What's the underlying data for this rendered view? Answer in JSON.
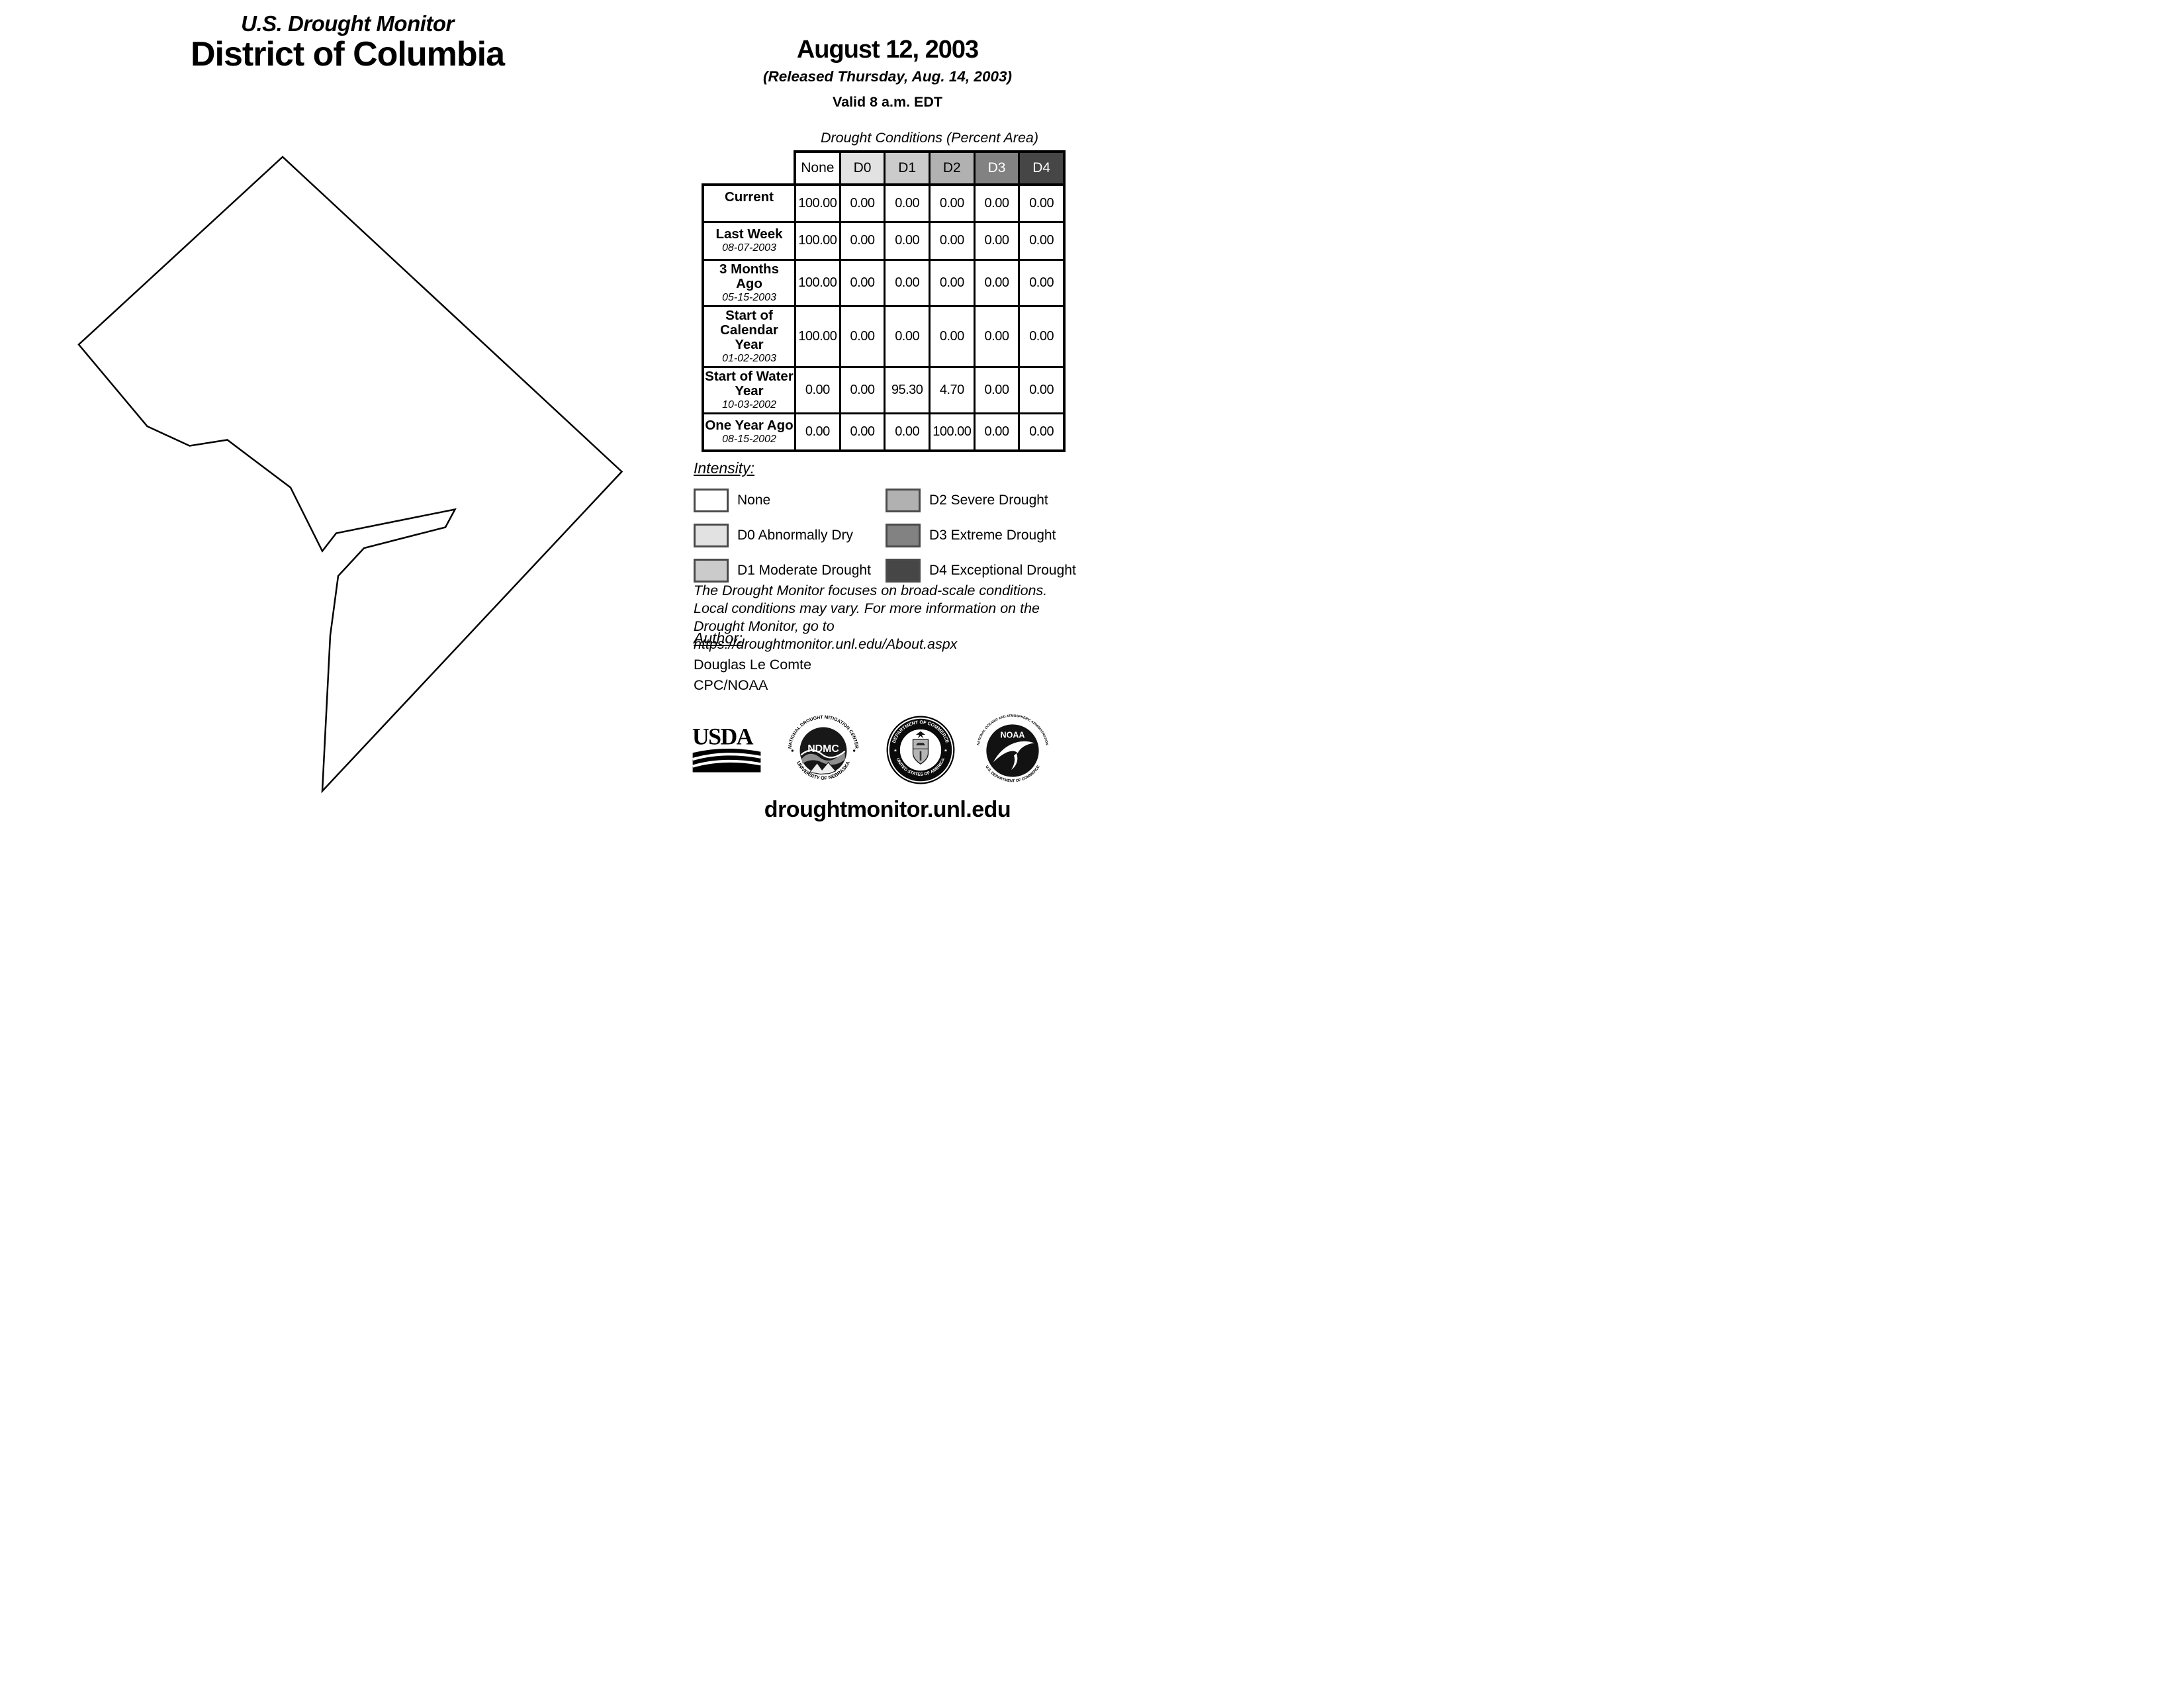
{
  "title": {
    "line1": "U.S. Drought Monitor",
    "line2": "District of Columbia"
  },
  "date_block": {
    "date": "August 12, 2003",
    "released": "(Released Thursday, Aug. 14, 2003)",
    "valid": "Valid 8 a.m. EDT"
  },
  "table": {
    "caption": "Drought Conditions (Percent Area)",
    "columns": [
      "None",
      "D0",
      "D1",
      "D2",
      "D3",
      "D4"
    ],
    "column_colors": [
      "#ffffff",
      "#e2e2e2",
      "#cbcbcb",
      "#b1b1b1",
      "#828282",
      "#464646"
    ],
    "column_text_colors": [
      "#000000",
      "#000000",
      "#000000",
      "#000000",
      "#ffffff",
      "#ffffff"
    ],
    "rows": [
      {
        "label": "Current",
        "date": "",
        "values": [
          "100.00",
          "0.00",
          "0.00",
          "0.00",
          "0.00",
          "0.00"
        ]
      },
      {
        "label": "Last Week",
        "date": "08-07-2003",
        "values": [
          "100.00",
          "0.00",
          "0.00",
          "0.00",
          "0.00",
          "0.00"
        ]
      },
      {
        "label": "3 Months Ago",
        "date": "05-15-2003",
        "values": [
          "100.00",
          "0.00",
          "0.00",
          "0.00",
          "0.00",
          "0.00"
        ]
      },
      {
        "label": "Start of Calendar Year",
        "date": "01-02-2003",
        "values": [
          "100.00",
          "0.00",
          "0.00",
          "0.00",
          "0.00",
          "0.00"
        ]
      },
      {
        "label": "Start of Water Year",
        "date": "10-03-2002",
        "values": [
          "0.00",
          "0.00",
          "95.30",
          "4.70",
          "0.00",
          "0.00"
        ]
      },
      {
        "label": "One Year Ago",
        "date": "08-15-2002",
        "values": [
          "0.00",
          "0.00",
          "0.00",
          "100.00",
          "0.00",
          "0.00"
        ]
      }
    ]
  },
  "legend": {
    "heading": "Intensity:",
    "items": [
      {
        "label": "None",
        "color": "#ffffff"
      },
      {
        "label": "D0 Abnormally Dry",
        "color": "#e2e2e2"
      },
      {
        "label": "D1 Moderate Drought",
        "color": "#cbcbcb"
      },
      {
        "label": "D2 Severe Drought",
        "color": "#b1b1b1"
      },
      {
        "label": "D3 Extreme Drought",
        "color": "#828282"
      },
      {
        "label": "D4 Exceptional Drought",
        "color": "#464646"
      }
    ]
  },
  "disclaimer": {
    "line1": "The Drought Monitor focuses on broad-scale conditions.",
    "line2": "Local conditions may vary. For more information on the",
    "line3": "Drought Monitor, go to https://droughtmonitor.unl.edu/About.aspx"
  },
  "author": {
    "heading": "Author:",
    "name": "Douglas Le Comte",
    "org": "CPC/NOAA"
  },
  "logos": {
    "usda": {
      "wordmark": "USDA"
    },
    "ndmc": {
      "ring_top": "NATIONAL DROUGHT MITIGATION CENTER",
      "ring_bottom": "UNIVERSITY OF NEBRASKA",
      "center": "NDMC"
    },
    "commerce": {
      "ring_top": "DEPARTMENT OF COMMERCE",
      "ring_bottom": "UNITED STATES OF AMERICA"
    },
    "noaa": {
      "ring_top": "NATIONAL OCEANIC AND ATMOSPHERIC ADMINISTRATION",
      "ring_bottom": "U.S. DEPARTMENT OF COMMERCE",
      "center": "NOAA"
    }
  },
  "footer": {
    "url": "droughtmonitor.unl.edu"
  }
}
